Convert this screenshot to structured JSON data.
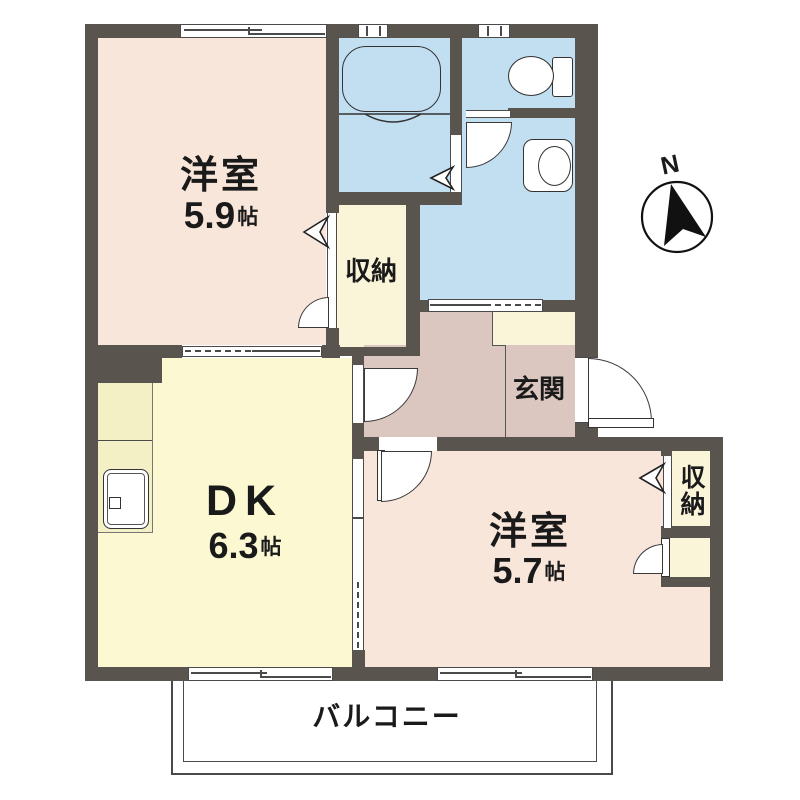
{
  "plan": {
    "rooms": {
      "western_room_1": {
        "label": "洋室",
        "area": "5.9",
        "area_unit": "帖"
      },
      "western_room_2": {
        "label": "洋室",
        "area": "5.7",
        "area_unit": "帖"
      },
      "dining_kitchen": {
        "label": "DK",
        "area": "6.3",
        "area_unit": "帖"
      },
      "entrance": {
        "label": "玄関"
      },
      "storage_1": {
        "label": "収納"
      },
      "storage_2": {
        "label": "収納"
      },
      "balcony": {
        "label": "バルコニー"
      }
    },
    "compass": {
      "label": "N"
    },
    "colors": {
      "wall": "#59544d",
      "western_room": "#f9e6da",
      "dining_kitchen": "#fbf8d2",
      "wet_area": "#c2dff2",
      "hallway_entrance": "#dcc6c0",
      "storage": "#faf5d9",
      "counter": "#f3f0c6",
      "balcony": "#ffffff"
    }
  }
}
